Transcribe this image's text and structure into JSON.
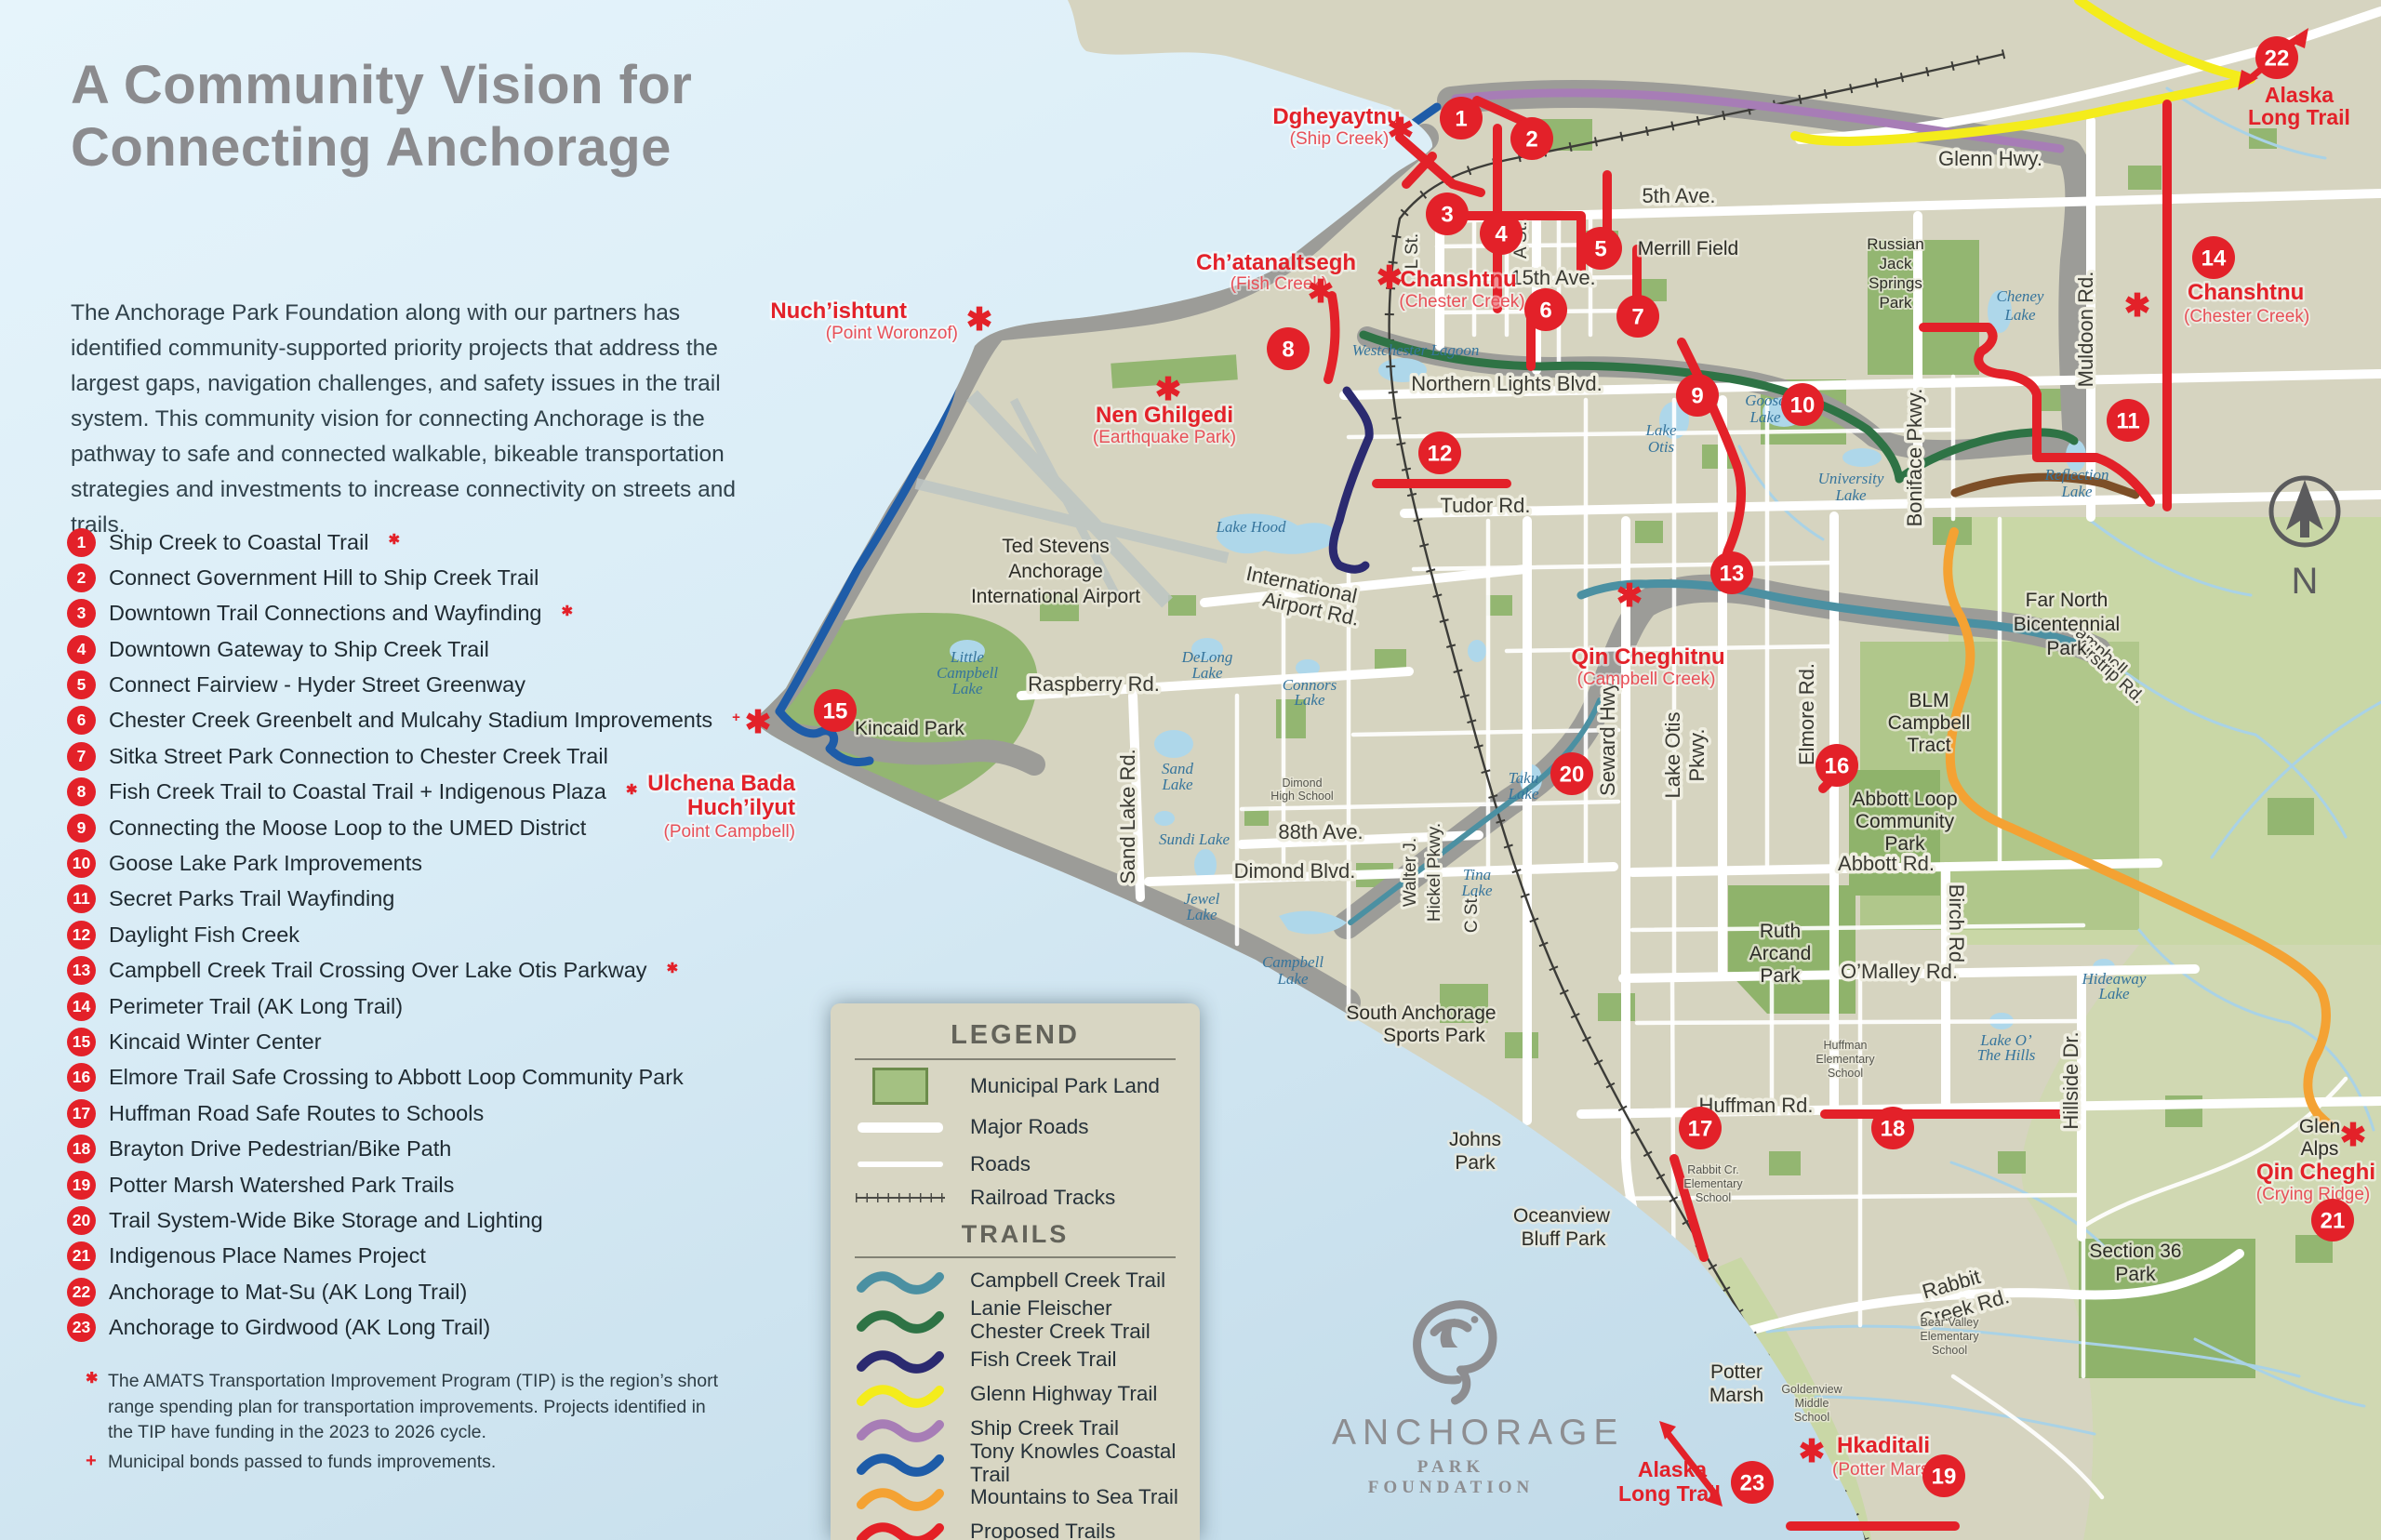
{
  "colors": {
    "marker_red": "#e32129",
    "title_gray": "#8b8b8e",
    "land_tan": "#d6d4c0",
    "water_blue": "#d9ecf6",
    "park_green": "#a4c182"
  },
  "symbols": {
    "asterisk": "✱",
    "plus": "+"
  },
  "panel": {
    "title_line1": "A Community Vision for",
    "title_line2": "Connecting Anchorage",
    "intro": "The Anchorage Park Foundation along with our partners has identified community-supported priority projects that address the largest gaps, navigation challenges, and safety issues in the trail system. This community vision for connecting Anchorage is the pathway to safe and connected walkable, bikeable transportation strategies and investments to increase connectivity on streets and trails.",
    "projects": [
      {
        "num": "1",
        "label": "Ship Creek to Coastal Trail",
        "mark": "✱"
      },
      {
        "num": "2",
        "label": "Connect Government Hill to Ship Creek Trail",
        "mark": ""
      },
      {
        "num": "3",
        "label": "Downtown Trail Connections and Wayfinding",
        "mark": "✱"
      },
      {
        "num": "4",
        "label": "Downtown Gateway to Ship Creek Trail",
        "mark": ""
      },
      {
        "num": "5",
        "label": "Connect Fairview - Hyder Street Greenway",
        "mark": ""
      },
      {
        "num": "6",
        "label": "Chester Creek Greenbelt and Mulcahy Stadium Improvements",
        "mark": "+"
      },
      {
        "num": "7",
        "label": "Sitka Street Park Connection to Chester Creek Trail",
        "mark": ""
      },
      {
        "num": "8",
        "label": "Fish Creek Trail to Coastal Trail + Indigenous Plaza",
        "mark": "✱"
      },
      {
        "num": "9",
        "label": "Connecting the Moose Loop to the UMED District",
        "mark": ""
      },
      {
        "num": "10",
        "label": "Goose Lake Park Improvements",
        "mark": ""
      },
      {
        "num": "11",
        "label": "Secret Parks Trail Wayfinding",
        "mark": ""
      },
      {
        "num": "12",
        "label": "Daylight Fish Creek",
        "mark": ""
      },
      {
        "num": "13",
        "label": "Campbell Creek Trail Crossing Over Lake Otis Parkway",
        "mark": "✱"
      },
      {
        "num": "14",
        "label": "Perimeter Trail (AK Long Trail)",
        "mark": ""
      },
      {
        "num": "15",
        "label": "Kincaid Winter Center",
        "mark": ""
      },
      {
        "num": "16",
        "label": "Elmore Trail Safe Crossing to Abbott Loop Community Park",
        "mark": ""
      },
      {
        "num": "17",
        "label": "Huffman Road Safe Routes to Schools",
        "mark": ""
      },
      {
        "num": "18",
        "label": "Brayton Drive Pedestrian/Bike Path",
        "mark": ""
      },
      {
        "num": "19",
        "label": "Potter Marsh Watershed Park Trails",
        "mark": ""
      },
      {
        "num": "20",
        "label": "Trail System-Wide Bike Storage and Lighting",
        "mark": ""
      },
      {
        "num": "21",
        "label": "Indigenous Place Names Project",
        "mark": ""
      },
      {
        "num": "22",
        "label": "Anchorage to Mat-Su (AK Long Trail)",
        "mark": ""
      },
      {
        "num": "23",
        "label": "Anchorage to Girdwood (AK Long Trail)",
        "mark": ""
      }
    ],
    "footnote_star": "The AMATS Transportation Improvement Program (TIP) is the region’s short range spending plan for transportation improvements. Projects identified in the TIP have funding in the 2023 to 2026 cycle.",
    "footnote_plus": "Municipal bonds passed to funds improvements."
  },
  "legend": {
    "title": "LEGEND",
    "land_items": [
      "Municipal Park Land",
      "Major Roads",
      "Roads",
      "Railroad Tracks"
    ],
    "trails_title": "TRAILS",
    "trail_items": [
      {
        "label": "Campbell Creek Trail",
        "label2": "",
        "color": "#4b90a2"
      },
      {
        "label": "Lanie Fleischer",
        "label2": "Chester Creek Trail",
        "color": "#2e7345"
      },
      {
        "label": "Fish Creek Trail",
        "label2": "",
        "color": "#2b2a70"
      },
      {
        "label": "Glenn Highway Trail",
        "label2": "",
        "color": "#f4ec1b"
      },
      {
        "label": "Ship Creek Trail",
        "label2": "",
        "color": "#a77db6"
      },
      {
        "label": "Tony Knowles Coastal Trail",
        "label2": "",
        "color": "#1e5ca8"
      },
      {
        "label": "Mountains to Sea Trail",
        "label2": "",
        "color": "#f4a233"
      },
      {
        "label": "Proposed Trails",
        "label2": "",
        "color": "#e42026"
      }
    ]
  },
  "logo": {
    "name": "ANCHORAGE",
    "tagline": "PARK FOUNDATION"
  },
  "map": {
    "compass_n": "N",
    "road_labels": [
      "Glenn Hwy.",
      "5th Ave.",
      "15th Ave.",
      "L St.",
      "A St.",
      "Northern Lights Blvd.",
      "Tudor Rd.",
      "International",
      "Airport Rd.",
      "Raspberry Rd.",
      "Sand Lake Rd.",
      "88th Ave.",
      "Dimond Blvd.",
      "Walter J.",
      "Hickel Pkwy.",
      "C St.",
      "Seward Hwy.",
      "Lake Otis",
      "Pkwy.",
      "Elmore Rd.",
      "Boniface Pkwy.",
      "Muldoon Rd.",
      "Abbott Rd.",
      "Birch Rd.",
      "O’Malley Rd.",
      "Huffman Rd.",
      "Hillside Dr.",
      "Rabbit",
      "Creek Rd.",
      "Campbell",
      "Airstrip Rd."
    ],
    "place_labels": [
      "Merrill Field",
      "Russian",
      "Jack",
      "Springs",
      "Park",
      "Ted Stevens",
      "Anchorage",
      "International Airport",
      "Kincaid Park",
      "Far North",
      "Bicentennial",
      "Park",
      "BLM",
      "Campbell",
      "Tract",
      "Abbott Loop",
      "Community",
      "Park",
      "Ruth",
      "Arcand",
      "Park",
      "South Anchorage",
      "Sports Park",
      "Johns",
      "Park",
      "Oceanview",
      "Bluff Park",
      "Potter",
      "Marsh",
      "Section 36",
      "Park",
      "Glen",
      "Alps"
    ],
    "lake_labels": [
      "Westchester Lagoon",
      "Lake Hood",
      "Lake",
      "Otis",
      "Goose",
      "Lake",
      "University",
      "Lake",
      "Cheney",
      "Lake",
      "Reflection",
      "Lake",
      "Little",
      "Campbell",
      "Lake",
      "DeLong",
      "Lake",
      "Sand",
      "Lake",
      "Sundi Lake",
      "Jewel",
      "Lake",
      "Campbell",
      "Lake",
      "Connors",
      "Lake",
      "Tina",
      "Lake",
      "Taku",
      "Lake",
      "Hideaway",
      "Lake",
      "Lake O’",
      "The Hills"
    ],
    "school_labels": [
      "Dimond",
      "High School",
      "Huffman",
      "Elementary",
      "School",
      "Rabbit Cr.",
      "Elementary",
      "School",
      "Bear Valley",
      "Elementary",
      "School",
      "Goldenview",
      "Middle",
      "School"
    ],
    "indigenous_labels": [
      "Dgheyaytnu",
      "(Ship Creek)",
      "Ch’atanaltsegh",
      "(Fish Creek)",
      "Chanshtnu",
      "(Chester Creek)",
      "Nuch’ishtunt",
      "(Point Woronzof)",
      "Nen Ghilgedi",
      "(Earthquake Park)",
      "Qin Cheghitnu",
      "(Campbell Creek)",
      "Ulchena Bada",
      "Huch’ilyut",
      "(Point Campbell)",
      "Chanshtnu",
      "(Chester Creek)",
      "Hkaditali",
      "(Potter Marsh)",
      "Qin Cheghi",
      "(Crying Ridge)"
    ],
    "alt_labels": [
      "Alaska",
      "Long Trail",
      "Alaska",
      "Long Trail"
    ]
  }
}
